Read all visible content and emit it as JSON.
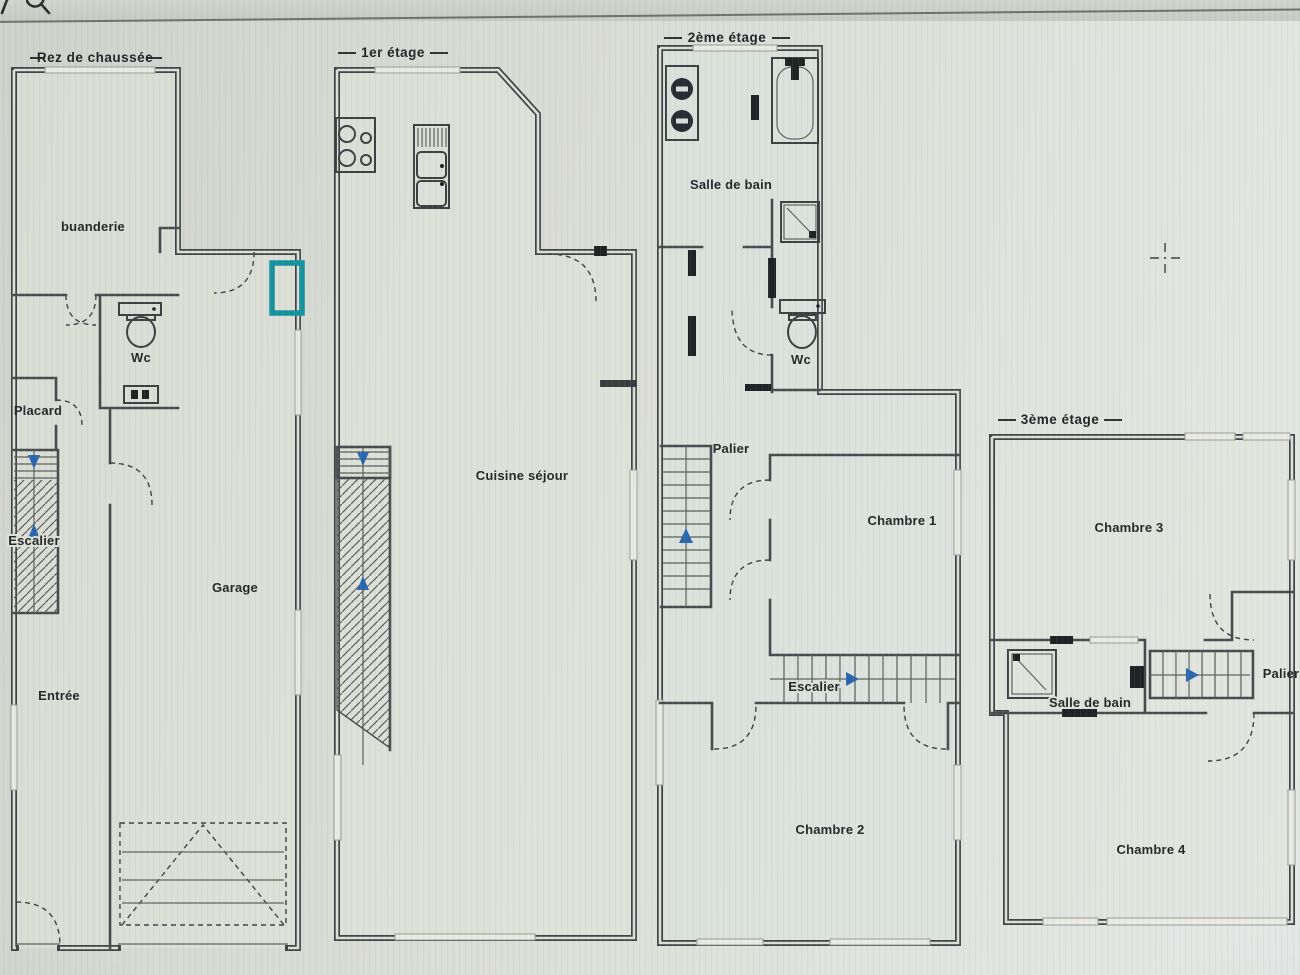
{
  "toolbar": {
    "icons": [
      "partial-glyph-icon",
      "search-icon"
    ]
  },
  "cursor": {
    "type": "crosshair"
  },
  "palette": {
    "paper": "#dadcd4",
    "wall": "#43474a",
    "ink": "#24282b",
    "arrow_blue": "#2a66ae",
    "teal_highlight": "#14929e"
  },
  "floors": {
    "rdc": {
      "title": "Rez de chaussée",
      "labels": {
        "buanderie": "buanderie",
        "wc": "Wc",
        "placard": "Placard",
        "escalier": "Escalier",
        "garage": "Garage",
        "entree": "Entrée"
      }
    },
    "etage1": {
      "title": "1er étage",
      "labels": {
        "cuisine_sejour": "Cuisine séjour"
      }
    },
    "etage2": {
      "title": "2ème étage",
      "labels": {
        "salle_de_bain": "Salle de bain",
        "wc": "Wc",
        "palier": "Palier",
        "chambre1": "Chambre 1",
        "escalier": "Escalier",
        "chambre2": "Chambre 2"
      }
    },
    "etage3": {
      "title": "3ème étage",
      "labels": {
        "chambre3": "Chambre 3",
        "salle_de_bain": "Salle de bain",
        "palier": "Palier",
        "chambre4": "Chambre 4"
      }
    }
  }
}
